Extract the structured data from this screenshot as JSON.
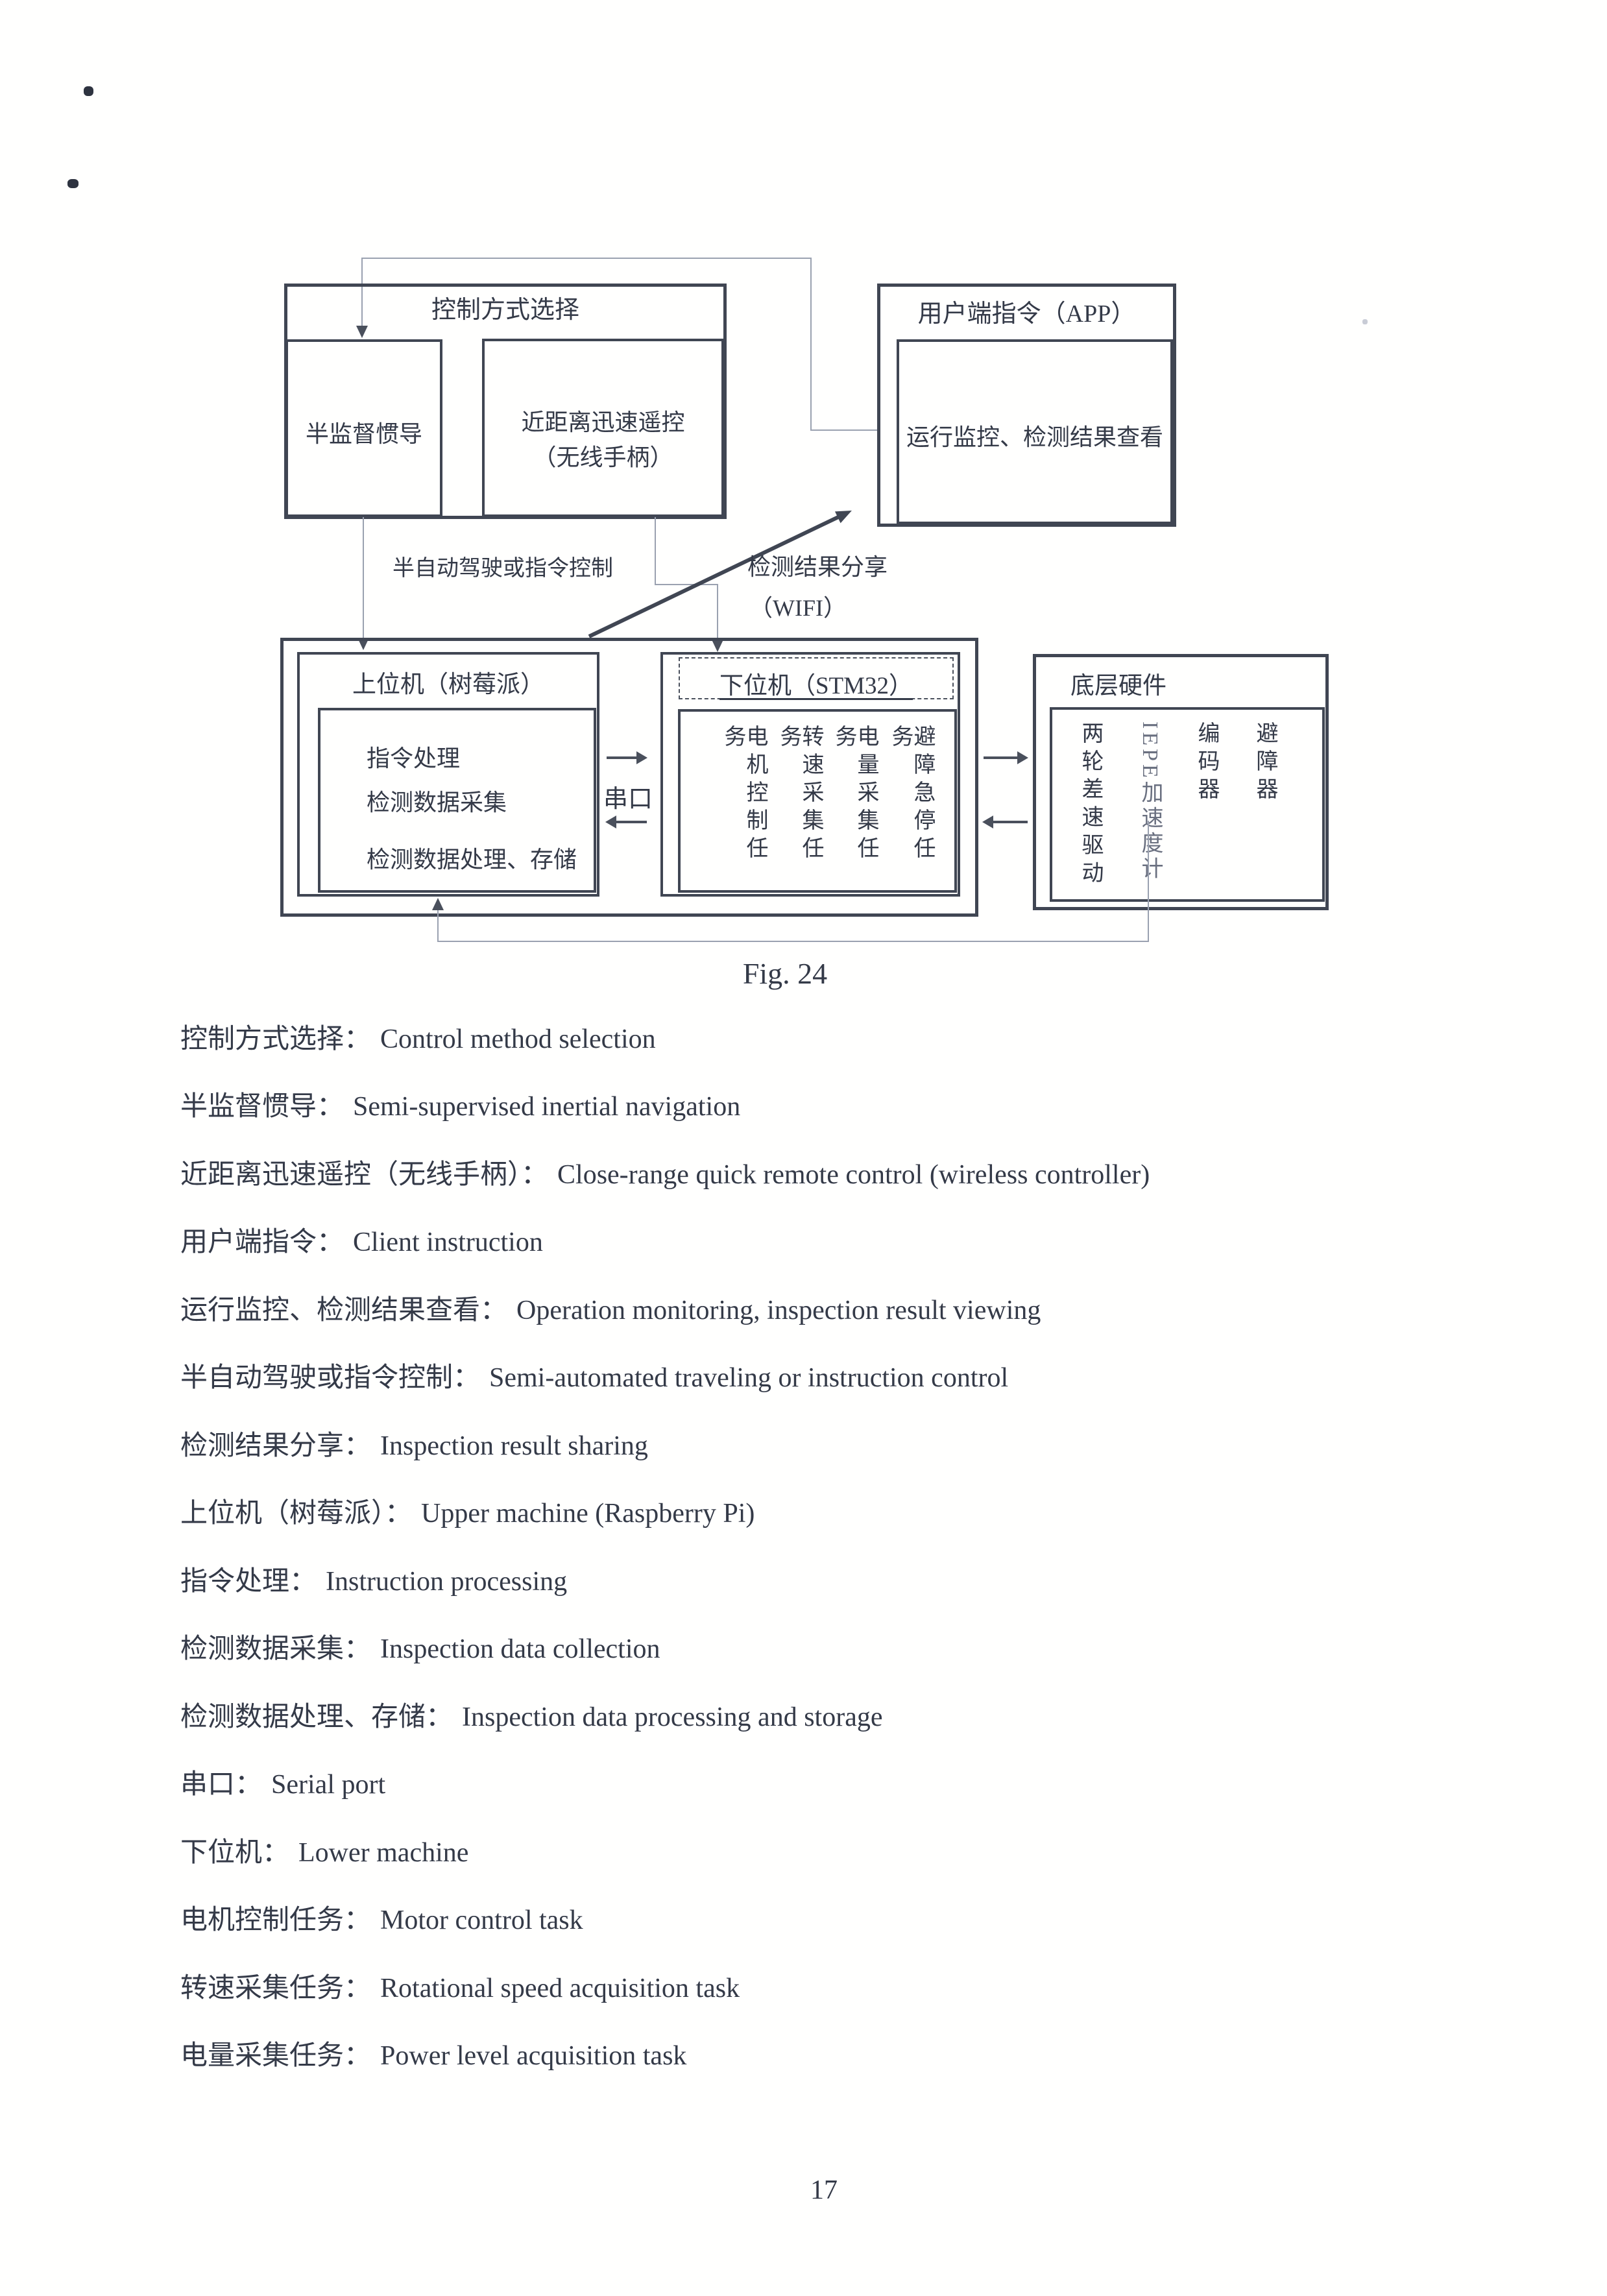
{
  "page": {
    "figure_caption": "Fig. 24",
    "page_number": "17"
  },
  "diagram": {
    "control_box": {
      "title": "控制方式选择",
      "left_option": "半监督惯导",
      "right_option_line1": "近距离迅速遥控",
      "right_option_line2": "（无线手柄）"
    },
    "client_box": {
      "title": "用户端指令（APP）",
      "content": "运行监控、检测结果查看"
    },
    "upper_box": {
      "title": "上位机（树莓派）",
      "items": [
        "指令处理",
        "检测数据采集",
        "检测数据处理、存储"
      ]
    },
    "lower_box": {
      "title": "下位机（STM32）",
      "tasks": [
        "电机控制任务",
        "转速采集任务",
        "电量采集任务",
        "避障急停任务"
      ]
    },
    "hardware_box": {
      "title": "底层硬件",
      "components": [
        "两轮差速驱动",
        "IEPE加速度计",
        "编码器",
        "避障器"
      ]
    },
    "labels": {
      "semi_auto": "半自动驾驶或指令控制",
      "share_line1": "检测结果分享",
      "share_line2": "（WIFI）",
      "serial_port": "串口"
    }
  },
  "glossary": [
    {
      "zh": "控制方式选择：",
      "en": "Control method selection"
    },
    {
      "zh": "半监督惯导：",
      "en": "Semi-supervised inertial navigation"
    },
    {
      "zh": "近距离迅速遥控（无线手柄）：",
      "en": "Close-range quick remote control (wireless controller)"
    },
    {
      "zh": "用户端指令：",
      "en": "Client instruction"
    },
    {
      "zh": "运行监控、检测结果查看：",
      "en": "Operation monitoring, inspection result viewing"
    },
    {
      "zh": "半自动驾驶或指令控制：",
      "en": "Semi-automated traveling or instruction control"
    },
    {
      "zh": "检测结果分享：",
      "en": "Inspection result sharing"
    },
    {
      "zh": "上位机（树莓派）：",
      "en": "Upper machine (Raspberry Pi)"
    },
    {
      "zh": "指令处理：",
      "en": "Instruction processing"
    },
    {
      "zh": "检测数据采集：",
      "en": "Inspection data collection"
    },
    {
      "zh": "检测数据处理、存储：",
      "en": "Inspection data processing and storage"
    },
    {
      "zh": "串口：",
      "en": "Serial port"
    },
    {
      "zh": "下位机：",
      "en": "Lower machine"
    },
    {
      "zh": "电机控制任务：",
      "en": "Motor control task"
    },
    {
      "zh": "转速采集任务：",
      "en": "Rotational speed acquisition task"
    },
    {
      "zh": "电量采集任务：",
      "en": "Power level acquisition task"
    }
  ]
}
